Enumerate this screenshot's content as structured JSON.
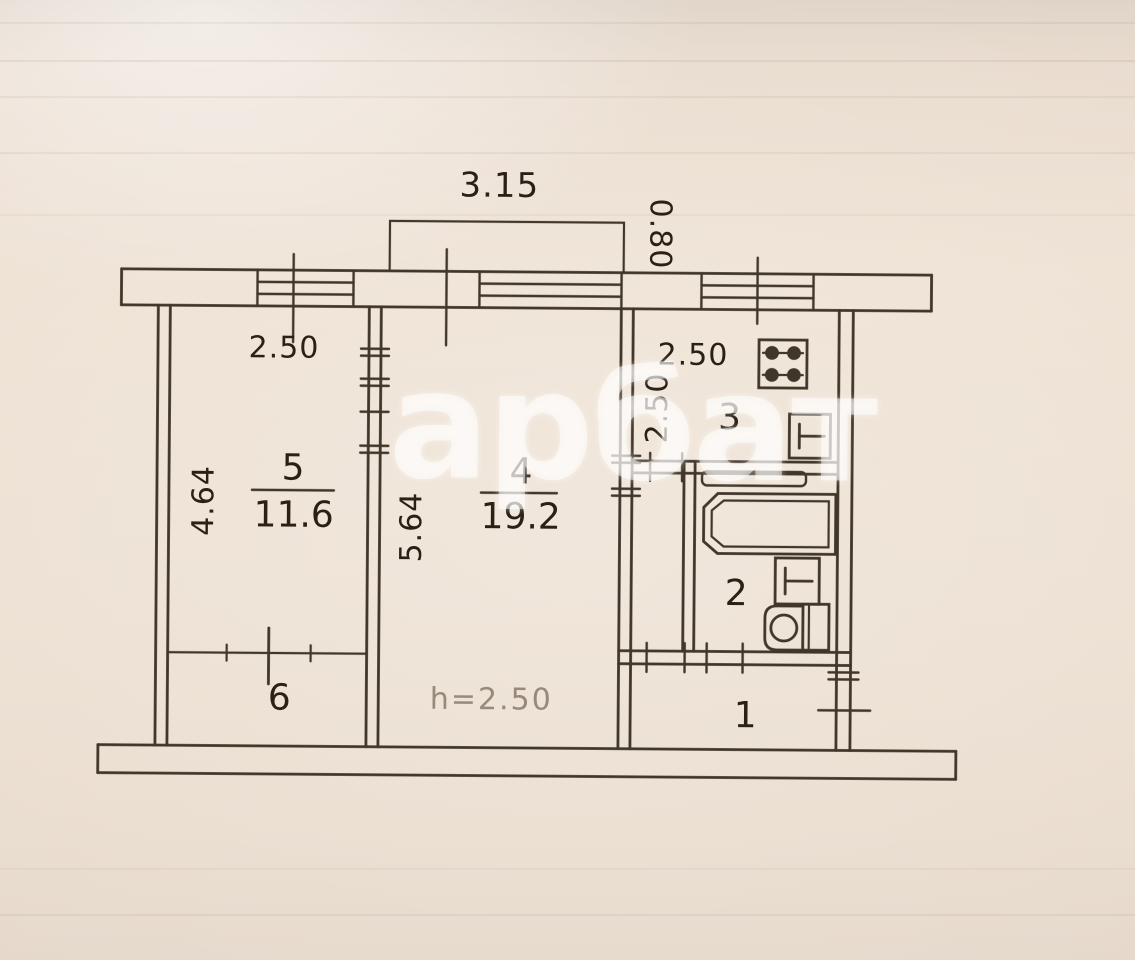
{
  "watermark": "арбат",
  "balcony": {
    "width": "3.15",
    "depth": "0.80"
  },
  "rooms": {
    "r1": {
      "number": "1"
    },
    "r2": {
      "number": "2"
    },
    "r3": {
      "number": "3",
      "width": "2.50",
      "height": "2.50"
    },
    "r4": {
      "number": "4",
      "area": "19.2",
      "height": "5.64",
      "ceiling": "h=2.50"
    },
    "r5": {
      "number": "5",
      "area": "11.6",
      "width": "2.50",
      "height": "4.64"
    },
    "r6": {
      "number": "6"
    }
  },
  "icons": {
    "fixtures": [
      "stove-icon",
      "kitchen-sink-icon",
      "shelf-icon",
      "bathtub-icon",
      "bathroom-sink-icon",
      "toilet-icon"
    ],
    "openings": [
      "window-icon",
      "balcony-outline",
      "door-opening-ticks",
      "entrance-door-opening"
    ]
  }
}
